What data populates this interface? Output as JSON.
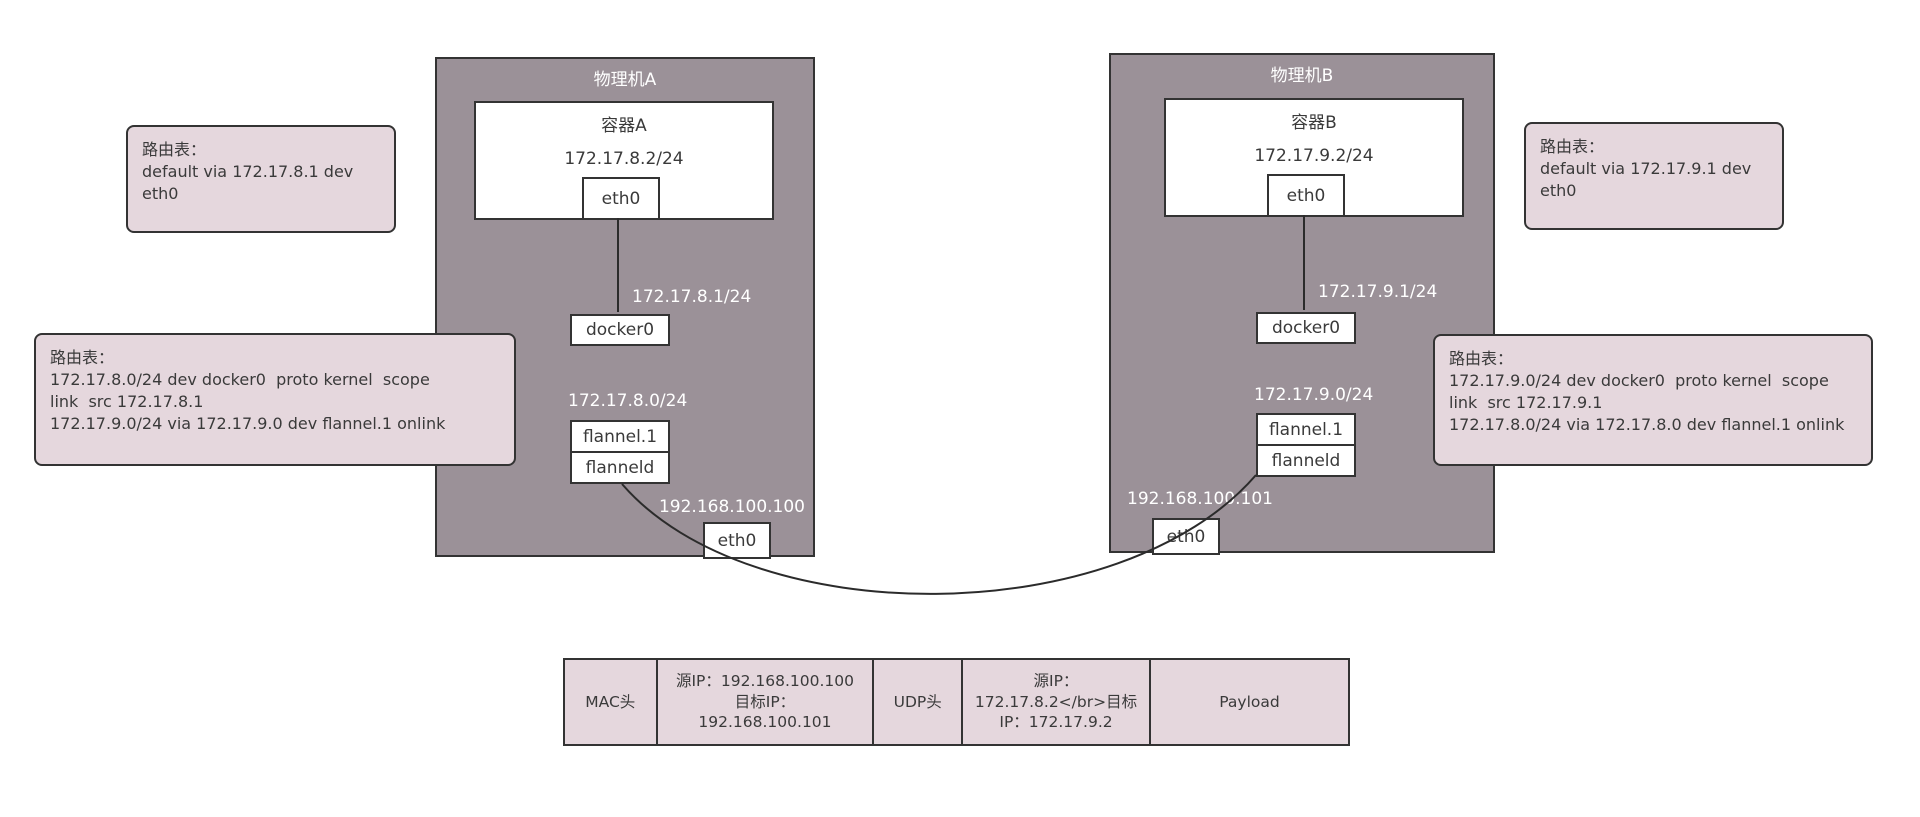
{
  "colors": {
    "machine_fill": "#9b9198",
    "panel_fill": "#e5d7dd",
    "border": "#333333",
    "white_label": "#ffffff",
    "dark_text": "#3a3a3a"
  },
  "machineA": {
    "title": "物理机A",
    "container": {
      "title": "容器A",
      "ip": "172.17.8.2/24",
      "iface": "eth0"
    },
    "docker0": {
      "label": "docker0",
      "ip": "172.17.8.1/24"
    },
    "flannel": {
      "iface": "flannel.1",
      "daemon": "flanneld",
      "subnet": "172.17.8.0/24"
    },
    "host_eth": {
      "label": "eth0",
      "ip": "192.168.100.100"
    }
  },
  "machineB": {
    "title": "物理机B",
    "container": {
      "title": "容器B",
      "ip": "172.17.9.2/24",
      "iface": "eth0"
    },
    "docker0": {
      "label": "docker0",
      "ip": "172.17.9.1/24"
    },
    "flannel": {
      "iface": "flannel.1",
      "daemon": "flanneld",
      "subnet": "172.17.9.0/24"
    },
    "host_eth": {
      "label": "eth0",
      "ip": "192.168.100.101"
    }
  },
  "route_tables": {
    "a_container": "路由表：\ndefault via 172.17.8.1 dev\neth0",
    "a_host": "路由表：\n172.17.8.0/24 dev docker0  proto kernel  scope\nlink  src 172.17.8.1\n172.17.9.0/24 via 172.17.9.0 dev flannel.1 onlink",
    "b_container": "路由表：\ndefault via 172.17.9.1 dev\neth0",
    "b_host": "路由表：\n172.17.9.0/24 dev docker0  proto kernel  scope\nlink  src 172.17.9.1\n172.17.8.0/24 via 172.17.8.0 dev flannel.1 onlink"
  },
  "packet": {
    "cells": [
      {
        "label": "MAC头"
      },
      {
        "label": "源IP：192.168.100.100\n目标IP：\n192.168.100.101"
      },
      {
        "label": "UDP头"
      },
      {
        "label": "源IP：\n172.17.8.2</br>目标\nIP：172.17.9.2"
      },
      {
        "label": "Payload"
      }
    ]
  }
}
